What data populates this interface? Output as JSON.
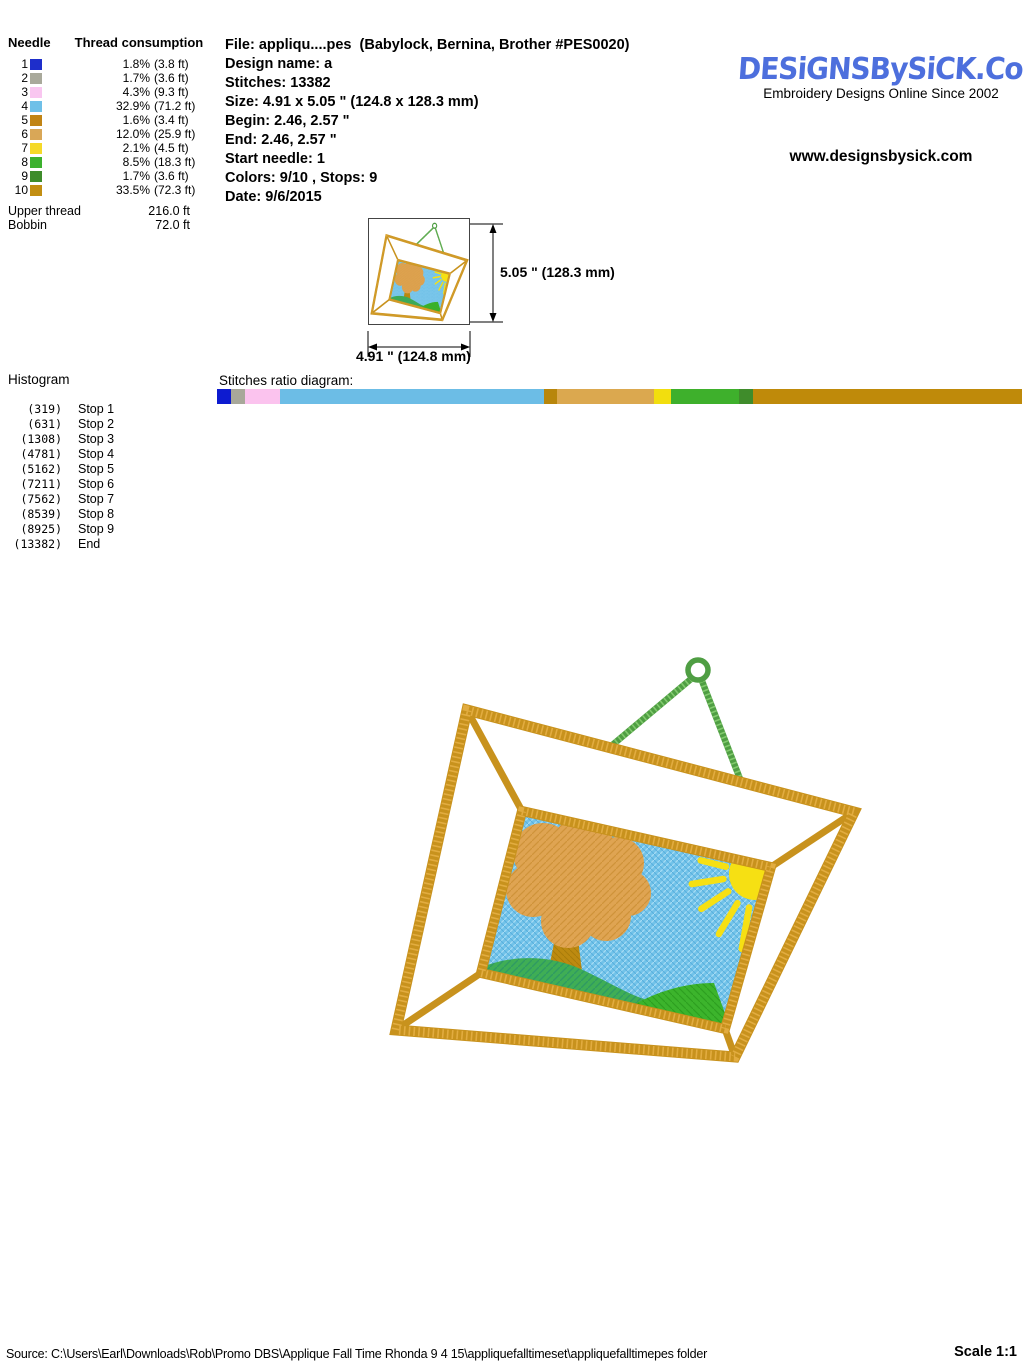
{
  "thread_table": {
    "col_needle": "Needle",
    "col_consumption": "Thread consumption",
    "rows": [
      {
        "needle": "1",
        "color": "#1e2ecb",
        "percent": "1.8%",
        "length": "(3.8 ft)"
      },
      {
        "needle": "2",
        "color": "#a9a99b",
        "percent": "1.7%",
        "length": "(3.6 ft)"
      },
      {
        "needle": "3",
        "color": "#f9c6f0",
        "percent": "4.3%",
        "length": "(9.3 ft)"
      },
      {
        "needle": "4",
        "color": "#6fc0e8",
        "percent": "32.9%",
        "length": "(71.2 ft)"
      },
      {
        "needle": "5",
        "color": "#c18414",
        "percent": "1.6%",
        "length": "(3.4 ft)"
      },
      {
        "needle": "6",
        "color": "#d9a757",
        "percent": "12.0%",
        "length": "(25.9 ft)"
      },
      {
        "needle": "7",
        "color": "#f5d928",
        "percent": "2.1%",
        "length": "(4.5 ft)"
      },
      {
        "needle": "8",
        "color": "#3cb12e",
        "percent": "8.5%",
        "length": "(18.3 ft)"
      },
      {
        "needle": "9",
        "color": "#3e8c2b",
        "percent": "1.7%",
        "length": "(3.6 ft)"
      },
      {
        "needle": "10",
        "color": "#c28e12",
        "percent": "33.5%",
        "length": "(72.3 ft)"
      }
    ],
    "upper_thread_label": "Upper thread",
    "upper_thread_value": "216.0 ft",
    "bobbin_label": "Bobbin",
    "bobbin_value": "72.0 ft"
  },
  "file_info": {
    "lines": [
      "File: appliqu....pes  (Babylock, Bernina, Brother #PES0020)",
      "Design name: a",
      "Stitches: 13382",
      "Size: 4.91 x 5.05 \" (124.8 x 128.3 mm)",
      "Begin: 2.46, 2.57 \"",
      "End: 2.46, 2.57 \"",
      "Start needle: 1",
      "Colors: 9/10 , Stops: 9",
      "Date: 9/6/2015"
    ]
  },
  "branding": {
    "logo_text": "DESiGNSBySiCK.CoM",
    "tagline": "Embroidery Designs Online Since 2002",
    "website": "www.designsbysick.com",
    "brand_color": "#4d6fdd"
  },
  "dimensions": {
    "height_label": "5.05 \" (128.3 mm)",
    "width_label": "4.91 \" (124.8 mm)"
  },
  "histogram": {
    "title": "Histogram",
    "rows": [
      {
        "count": "(319)",
        "label": "Stop 1"
      },
      {
        "count": "(631)",
        "label": "Stop 2"
      },
      {
        "count": "(1308)",
        "label": "Stop 3"
      },
      {
        "count": "(4781)",
        "label": "Stop 4"
      },
      {
        "count": "(5162)",
        "label": "Stop 5"
      },
      {
        "count": "(7211)",
        "label": "Stop 6"
      },
      {
        "count": "(7562)",
        "label": "Stop 7"
      },
      {
        "count": "(8539)",
        "label": "Stop 8"
      },
      {
        "count": "(8925)",
        "label": "Stop 9"
      },
      {
        "count": "(13382)",
        "label": "End"
      }
    ]
  },
  "ratio_diagram": {
    "label": "Stitches ratio diagram:",
    "segments": [
      {
        "color": "#0d1bd0",
        "percent": 1.8
      },
      {
        "color": "#a8a89a",
        "percent": 1.7
      },
      {
        "color": "#fbc3ee",
        "percent": 4.3
      },
      {
        "color": "#6cbde6",
        "percent": 32.9
      },
      {
        "color": "#b8860b",
        "percent": 1.6
      },
      {
        "color": "#dba84f",
        "percent": 12.0
      },
      {
        "color": "#f2de0e",
        "percent": 2.1
      },
      {
        "color": "#3eb02c",
        "percent": 8.5
      },
      {
        "color": "#3f8c2b",
        "percent": 1.7
      },
      {
        "color": "#bf8a0a",
        "percent": 33.5
      }
    ]
  },
  "design": {
    "description": "applique picture frame with tree, sun and hills, hanging from a green hanger",
    "colors": {
      "frame_gold": "#c8921d",
      "frame_gold_light": "#e2ac40",
      "hanger_green": "#4f9e43",
      "hanger_green_light": "#82ca6e",
      "sky_blue": "#72c3e9",
      "sky_light": "#a5dbf4",
      "sky_dark": "#58b0de",
      "tree_orange": "#dfa452",
      "tree_orange_dark": "#cf9339",
      "trunk_brown": "#bd8a10",
      "trunk_dark": "#a87c0a",
      "sun_yellow": "#f6e013",
      "hill_left": "#3fae55",
      "hill_left_dark": "#2f9a62",
      "hill_right": "#3cb42c",
      "hill_right_dark": "#2da01f"
    }
  },
  "footer": {
    "source": "Source: C:\\Users\\Earl\\Downloads\\Rob\\Promo DBS\\Applique Fall Time Rhonda 9 4 15\\appliquefalltimeset\\appliquefalltimepes folder",
    "scale": "Scale 1:1"
  }
}
